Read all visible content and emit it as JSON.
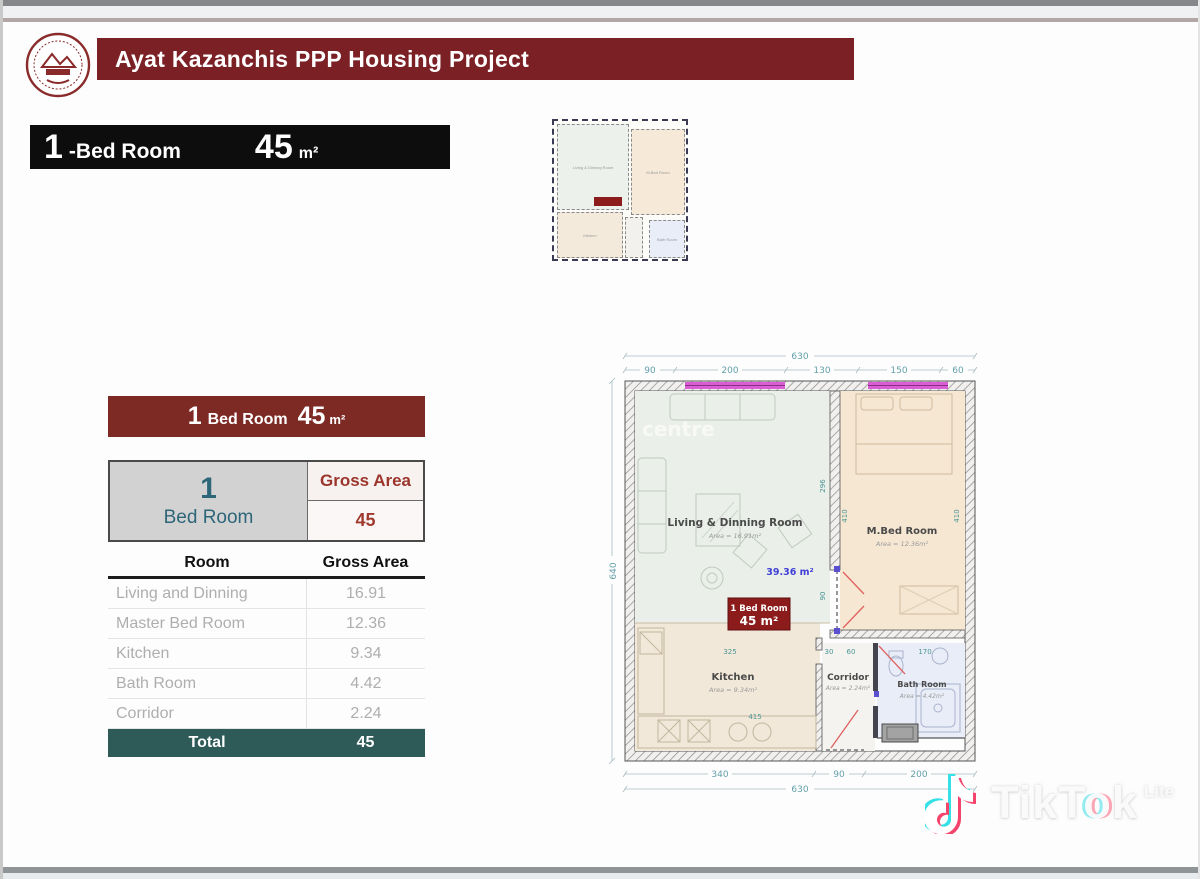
{
  "header": {
    "title": "Ayat Kazanchis PPP Housing Project",
    "logo": "ayat-real-estate-seal"
  },
  "title_banner": {
    "number": "1",
    "label": "-Bed Room",
    "area": "45",
    "unit": "m²"
  },
  "summary": {
    "banner": {
      "number": "1",
      "label": "Bed Room",
      "area": "45",
      "unit": "m²"
    },
    "unit_cell": {
      "number": "1",
      "label": "Bed Room"
    },
    "gross_label": "Gross Area",
    "gross_value": "45",
    "columns": [
      "Room",
      "Gross Area"
    ],
    "rows": [
      {
        "room": "Living and Dinning",
        "area": "16.91"
      },
      {
        "room": "Master Bed Room",
        "area": "12.36"
      },
      {
        "room": "Kitchen",
        "area": "9.34"
      },
      {
        "room": "Bath Room",
        "area": "4.42"
      },
      {
        "room": "Corridor",
        "area": "2.24"
      }
    ],
    "total_label": "Total",
    "total_value": "45"
  },
  "floorplan": {
    "dims": {
      "top_total": "630",
      "top_segments": [
        "90",
        "200",
        "130",
        "150",
        "60"
      ],
      "left": "640",
      "bottom_segments": [
        "340",
        "90",
        "200"
      ],
      "bottom_total": "630",
      "interior": {
        "living_width": "325",
        "kitchen_counter": "415",
        "corridor_w1": "30",
        "corridor_w2": "60",
        "bath_width": "170",
        "mbed_height_a": "410",
        "mbed_height_b": "410",
        "living_height": "296",
        "door_height": "90"
      }
    },
    "rooms": {
      "living": {
        "name": "Living & Dinning Room",
        "area": "Area = 16.91m²"
      },
      "mbed": {
        "name": "M.Bed Room",
        "area": "Area = 12.36m²"
      },
      "kitchen": {
        "name": "Kitchen",
        "area": "Area = 9.34m²"
      },
      "corridor": {
        "name": "Corridor",
        "area": "Area = 2.24m²"
      },
      "bath": {
        "name": "Bath Room",
        "area": "Area = 4.42m²"
      }
    },
    "annotation": "39.36 m²",
    "badge": {
      "line1": "1 Bed Room",
      "line2": "45 m²"
    },
    "watermark": "centre"
  },
  "tiktok": {
    "part1": "TikT",
    "part2": "o",
    "part3": "k",
    "variant": "Lite"
  },
  "colors": {
    "maroon_banner": "#7b2125",
    "table_maroon": "#7e2a24",
    "badge_red": "#8c1c1c",
    "total_teal": "#2e5a58",
    "teal_text": "#2e6679",
    "gross_red_text": "#9c352b",
    "window_magenta": "#da5ed3",
    "annotation_blue": "#3f3fd6",
    "dim_teal": "#58a0a4"
  }
}
